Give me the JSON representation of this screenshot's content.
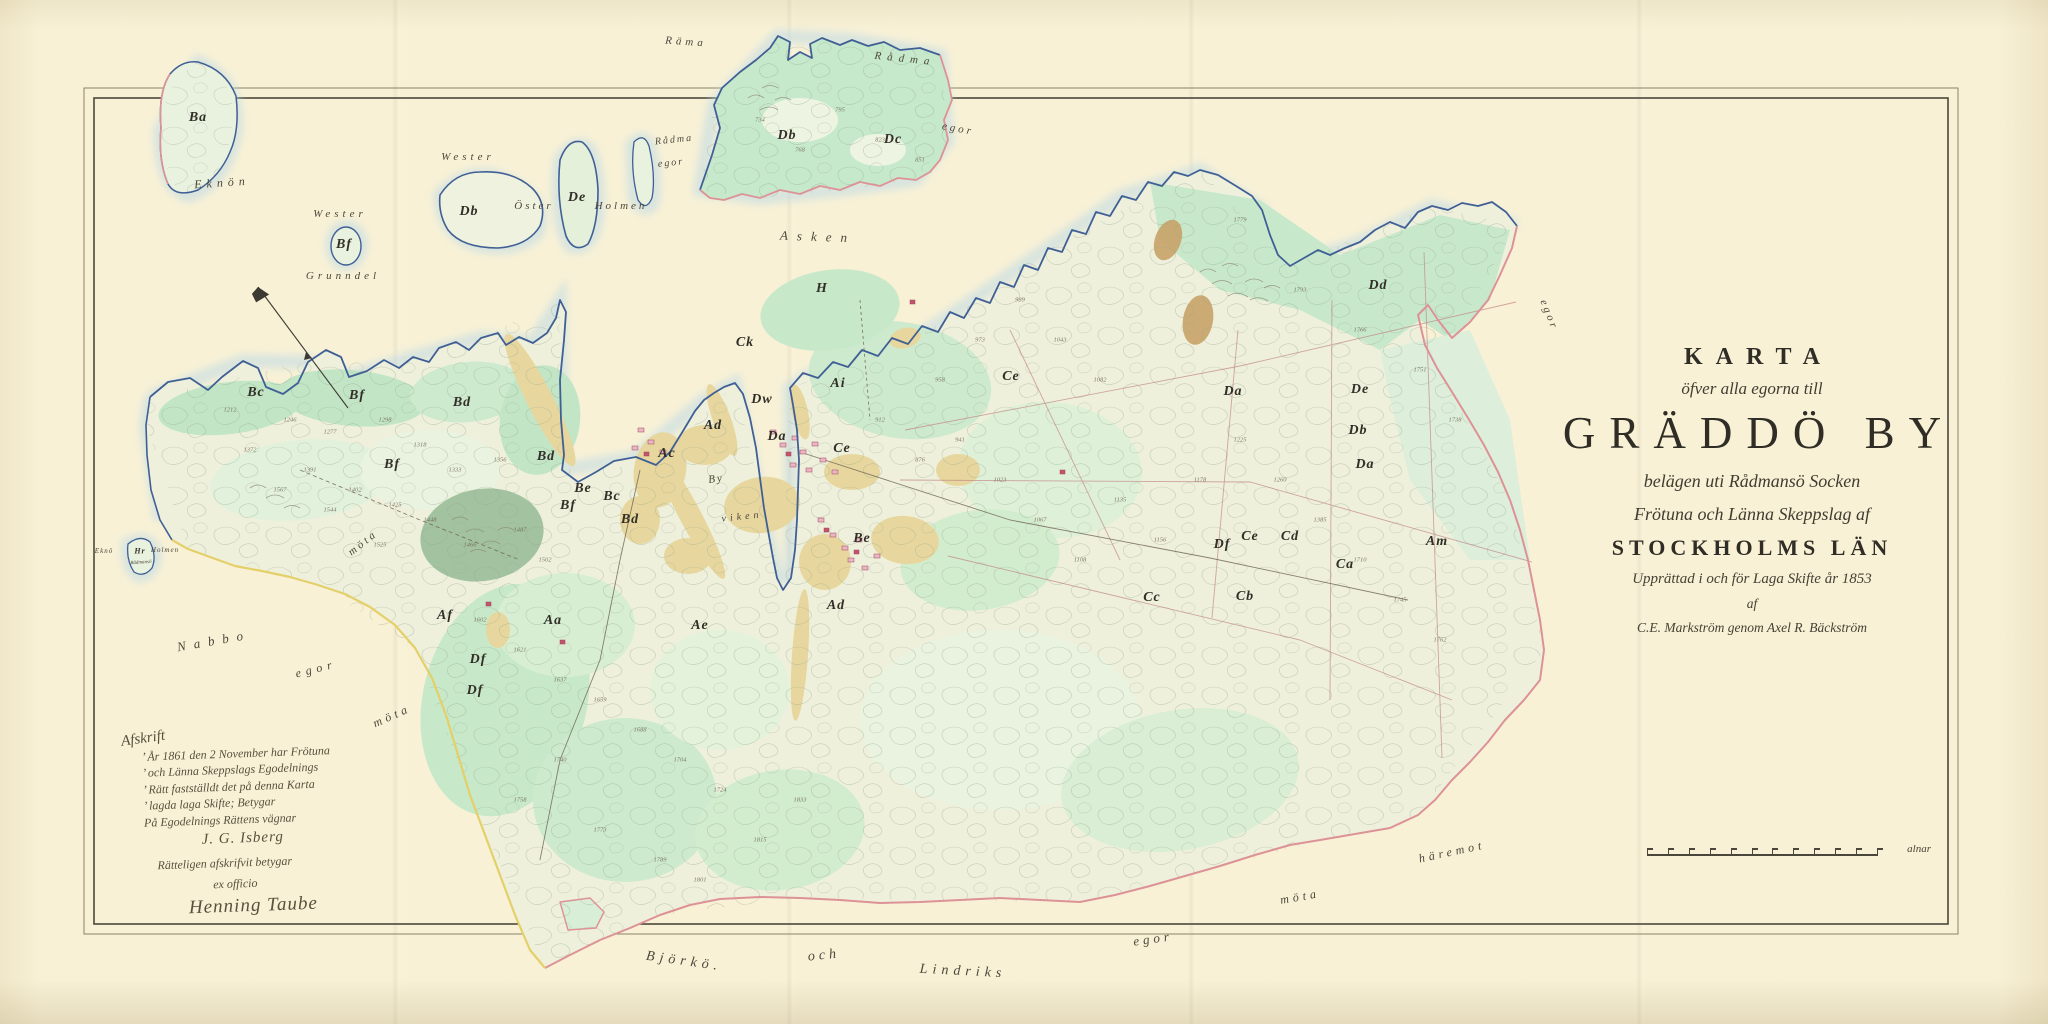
{
  "title_block": {
    "l1": "KARTA",
    "l2": "öfver alla egorna till",
    "l3": "GRÄDDÖ BY",
    "l4": "belägen uti Rådmansö Socken",
    "l5": "Frötuna och Länna Skeppslag af",
    "l6": "STOCKHOLMS LÄN",
    "l7": "Upprättad i och för Laga Skifte år 1853",
    "l8": "af",
    "l9": "C.E. Markström genom Axel R. Bäckström"
  },
  "certification_note": {
    "heading": "Afskrift",
    "lines": [
      "’ År 1861 den 2 November har Frötuna",
      "’ och Länna Skeppslags Egodelnings",
      "’ Rätt fastställdt det på denna Karta",
      "’ lagda laga Skifte;  Betygar",
      "På Egodelnings Rättens vägnar"
    ],
    "signature1": "J. G. Isberg",
    "attest": "Rätteligen afskrifvit betygar",
    "ex_officio": "ex officio",
    "signature2": "Henning Taube"
  },
  "scale_bar": {
    "ticks": 12,
    "unit_label": "alnar"
  },
  "compass": {
    "name": "north-needle"
  },
  "place_labels": [
    {
      "t": "Eknön",
      "x": 222,
      "y": 183,
      "s": 12,
      "ls": 5,
      "r": -4
    },
    {
      "t": "Wester",
      "x": 340,
      "y": 214,
      "s": 11,
      "ls": 4,
      "r": 0
    },
    {
      "t": "Grunndel",
      "x": 343,
      "y": 276,
      "s": 11,
      "ls": 4,
      "r": 0
    },
    {
      "t": "Wester",
      "x": 468,
      "y": 157,
      "s": 11,
      "ls": 4,
      "r": 0
    },
    {
      "t": "Öster",
      "x": 534,
      "y": 206,
      "s": 11,
      "ls": 3,
      "r": 0
    },
    {
      "t": "Holmen",
      "x": 621,
      "y": 206,
      "s": 11,
      "ls": 3,
      "r": 0
    },
    {
      "t": "Räma",
      "x": 686,
      "y": 42,
      "s": 11,
      "ls": 4,
      "r": 4
    },
    {
      "t": "Rådma",
      "x": 674,
      "y": 140,
      "s": 10,
      "ls": 2,
      "r": -6
    },
    {
      "t": "egor",
      "x": 671,
      "y": 163,
      "s": 10,
      "ls": 2,
      "r": -6
    },
    {
      "t": "Rådma",
      "x": 905,
      "y": 59,
      "s": 11,
      "ls": 6,
      "r": 6
    },
    {
      "t": "egor",
      "x": 958,
      "y": 129,
      "s": 11,
      "ls": 3,
      "r": 10
    },
    {
      "t": "Asken",
      "x": 818,
      "y": 237,
      "s": 13,
      "ls": 9,
      "r": 2
    },
    {
      "t": "By",
      "x": 716,
      "y": 479,
      "s": 11,
      "ls": 2,
      "r": -8
    },
    {
      "t": "viken",
      "x": 742,
      "y": 517,
      "s": 10,
      "ls": 4,
      "r": -6
    },
    {
      "t": "Nabbo",
      "x": 214,
      "y": 641,
      "s": 13,
      "ls": 8,
      "r": -10
    },
    {
      "t": "egor",
      "x": 316,
      "y": 669,
      "s": 12,
      "ls": 5,
      "r": -14
    },
    {
      "t": "möta",
      "x": 392,
      "y": 716,
      "s": 12,
      "ls": 4,
      "r": -24
    },
    {
      "t": "möta",
      "x": 363,
      "y": 543,
      "s": 11,
      "ls": 3,
      "r": -38
    },
    {
      "t": "Björkö.",
      "x": 684,
      "y": 962,
      "s": 14,
      "ls": 5,
      "r": 8
    },
    {
      "t": "och",
      "x": 824,
      "y": 956,
      "s": 14,
      "ls": 4,
      "r": -6
    },
    {
      "t": "Lindriks",
      "x": 963,
      "y": 972,
      "s": 14,
      "ls": 5,
      "r": 3
    },
    {
      "t": "egor",
      "x": 1153,
      "y": 939,
      "s": 13,
      "ls": 4,
      "r": -8
    },
    {
      "t": "möta",
      "x": 1300,
      "y": 897,
      "s": 12,
      "ls": 4,
      "r": -10
    },
    {
      "t": "häremot",
      "x": 1452,
      "y": 852,
      "s": 12,
      "ls": 4,
      "r": -12
    },
    {
      "t": "egor",
      "x": 1549,
      "y": 315,
      "s": 11,
      "ls": 3,
      "r": 68
    },
    {
      "t": "Eknö",
      "x": 104,
      "y": 551,
      "s": 7,
      "ls": 1,
      "r": 0
    },
    {
      "t": "Holmen",
      "x": 165,
      "y": 550,
      "s": 7,
      "ls": 1,
      "r": 0
    },
    {
      "t": "Rådmansö",
      "x": 141,
      "y": 563,
      "s": 5,
      "ls": 0,
      "r": -4
    }
  ],
  "parcel_labels": [
    {
      "t": "Ba",
      "x": 198,
      "y": 118
    },
    {
      "t": "Bf",
      "x": 344,
      "y": 245
    },
    {
      "t": "Db",
      "x": 469,
      "y": 212
    },
    {
      "t": "De",
      "x": 577,
      "y": 198
    },
    {
      "t": "Db",
      "x": 787,
      "y": 136
    },
    {
      "t": "Dc",
      "x": 893,
      "y": 140
    },
    {
      "t": "Hr",
      "x": 140,
      "y": 551,
      "s": 8
    },
    {
      "t": "Bc",
      "x": 256,
      "y": 393
    },
    {
      "t": "Bf",
      "x": 357,
      "y": 396
    },
    {
      "t": "Bd",
      "x": 462,
      "y": 403
    },
    {
      "t": "Bf",
      "x": 392,
      "y": 465
    },
    {
      "t": "Bd",
      "x": 546,
      "y": 457
    },
    {
      "t": "Be",
      "x": 583,
      "y": 489
    },
    {
      "t": "Bc",
      "x": 612,
      "y": 497
    },
    {
      "t": "Bf",
      "x": 568,
      "y": 506
    },
    {
      "t": "Bd",
      "x": 630,
      "y": 520
    },
    {
      "t": "H",
      "x": 822,
      "y": 289
    },
    {
      "t": "Ck",
      "x": 745,
      "y": 343
    },
    {
      "t": "Ce",
      "x": 1011,
      "y": 377
    },
    {
      "t": "Ai",
      "x": 838,
      "y": 384
    },
    {
      "t": "Dw",
      "x": 762,
      "y": 400
    },
    {
      "t": "Ad",
      "x": 713,
      "y": 426
    },
    {
      "t": "Ac",
      "x": 667,
      "y": 454
    },
    {
      "t": "Da",
      "x": 777,
      "y": 437
    },
    {
      "t": "Ce",
      "x": 842,
      "y": 449
    },
    {
      "t": "Aa",
      "x": 553,
      "y": 621
    },
    {
      "t": "Af",
      "x": 445,
      "y": 616
    },
    {
      "t": "Df",
      "x": 478,
      "y": 660
    },
    {
      "t": "Df",
      "x": 475,
      "y": 691
    },
    {
      "t": "Ae",
      "x": 700,
      "y": 626
    },
    {
      "t": "Ad",
      "x": 836,
      "y": 606
    },
    {
      "t": "Be",
      "x": 862,
      "y": 539
    },
    {
      "t": "Dd",
      "x": 1378,
      "y": 286
    },
    {
      "t": "Da",
      "x": 1233,
      "y": 392
    },
    {
      "t": "De",
      "x": 1360,
      "y": 390
    },
    {
      "t": "Db",
      "x": 1358,
      "y": 431
    },
    {
      "t": "Da",
      "x": 1365,
      "y": 465
    },
    {
      "t": "Df",
      "x": 1222,
      "y": 545
    },
    {
      "t": "Ce",
      "x": 1250,
      "y": 537
    },
    {
      "t": "Cd",
      "x": 1290,
      "y": 537
    },
    {
      "t": "Ca",
      "x": 1345,
      "y": 565
    },
    {
      "t": "Cb",
      "x": 1245,
      "y": 597
    },
    {
      "t": "Cc",
      "x": 1152,
      "y": 598
    },
    {
      "t": "Am",
      "x": 1437,
      "y": 542
    }
  ],
  "parcel_numbers": [
    {
      "t": "1212",
      "x": 230,
      "y": 410
    },
    {
      "t": "1246",
      "x": 290,
      "y": 420
    },
    {
      "t": "1277",
      "x": 330,
      "y": 432
    },
    {
      "t": "1298",
      "x": 385,
      "y": 420
    },
    {
      "t": "1318",
      "x": 420,
      "y": 445
    },
    {
      "t": "1333",
      "x": 455,
      "y": 470
    },
    {
      "t": "1356",
      "x": 500,
      "y": 460
    },
    {
      "t": "1372",
      "x": 250,
      "y": 450
    },
    {
      "t": "1391",
      "x": 310,
      "y": 470
    },
    {
      "t": "1402",
      "x": 355,
      "y": 490
    },
    {
      "t": "1425",
      "x": 395,
      "y": 505
    },
    {
      "t": "1448",
      "x": 430,
      "y": 520
    },
    {
      "t": "1466",
      "x": 470,
      "y": 545
    },
    {
      "t": "1487",
      "x": 520,
      "y": 530
    },
    {
      "t": "1502",
      "x": 545,
      "y": 560
    },
    {
      "t": "1525",
      "x": 380,
      "y": 545
    },
    {
      "t": "1544",
      "x": 330,
      "y": 510
    },
    {
      "t": "1567",
      "x": 280,
      "y": 490
    },
    {
      "t": "1602",
      "x": 480,
      "y": 620
    },
    {
      "t": "1621",
      "x": 520,
      "y": 650
    },
    {
      "t": "1637",
      "x": 560,
      "y": 680
    },
    {
      "t": "1659",
      "x": 600,
      "y": 700
    },
    {
      "t": "1688",
      "x": 640,
      "y": 730
    },
    {
      "t": "1704",
      "x": 680,
      "y": 760
    },
    {
      "t": "1724",
      "x": 720,
      "y": 790
    },
    {
      "t": "1740",
      "x": 560,
      "y": 760
    },
    {
      "t": "1758",
      "x": 520,
      "y": 800
    },
    {
      "t": "1773",
      "x": 600,
      "y": 830
    },
    {
      "t": "1789",
      "x": 660,
      "y": 860
    },
    {
      "t": "1801",
      "x": 700,
      "y": 880
    },
    {
      "t": "1815",
      "x": 760,
      "y": 840
    },
    {
      "t": "1833",
      "x": 800,
      "y": 800
    },
    {
      "t": "912",
      "x": 880,
      "y": 420
    },
    {
      "t": "876",
      "x": 920,
      "y": 460
    },
    {
      "t": "941",
      "x": 960,
      "y": 440
    },
    {
      "t": "1023",
      "x": 1000,
      "y": 480
    },
    {
      "t": "1067",
      "x": 1040,
      "y": 520
    },
    {
      "t": "1108",
      "x": 1080,
      "y": 560
    },
    {
      "t": "1135",
      "x": 1120,
      "y": 500
    },
    {
      "t": "1156",
      "x": 1160,
      "y": 540
    },
    {
      "t": "1178",
      "x": 1200,
      "y": 480
    },
    {
      "t": "958",
      "x": 940,
      "y": 380
    },
    {
      "t": "973",
      "x": 980,
      "y": 340
    },
    {
      "t": "989",
      "x": 1020,
      "y": 300
    },
    {
      "t": "1043",
      "x": 1060,
      "y": 340
    },
    {
      "t": "1082",
      "x": 1100,
      "y": 380
    },
    {
      "t": "1225",
      "x": 1240,
      "y": 440
    },
    {
      "t": "1260",
      "x": 1280,
      "y": 480
    },
    {
      "t": "1385",
      "x": 1320,
      "y": 520
    },
    {
      "t": "1710",
      "x": 1360,
      "y": 560
    },
    {
      "t": "1745",
      "x": 1400,
      "y": 600
    },
    {
      "t": "1762",
      "x": 1440,
      "y": 640
    },
    {
      "t": "734",
      "x": 760,
      "y": 120
    },
    {
      "t": "768",
      "x": 800,
      "y": 150
    },
    {
      "t": "795",
      "x": 840,
      "y": 110
    },
    {
      "t": "823",
      "x": 880,
      "y": 140
    },
    {
      "t": "851",
      "x": 920,
      "y": 160
    },
    {
      "t": "1779",
      "x": 1240,
      "y": 220
    },
    {
      "t": "1793",
      "x": 1300,
      "y": 290
    },
    {
      "t": "1766",
      "x": 1360,
      "y": 330
    },
    {
      "t": "1751",
      "x": 1420,
      "y": 370
    },
    {
      "t": "1738",
      "x": 1455,
      "y": 420
    }
  ]
}
